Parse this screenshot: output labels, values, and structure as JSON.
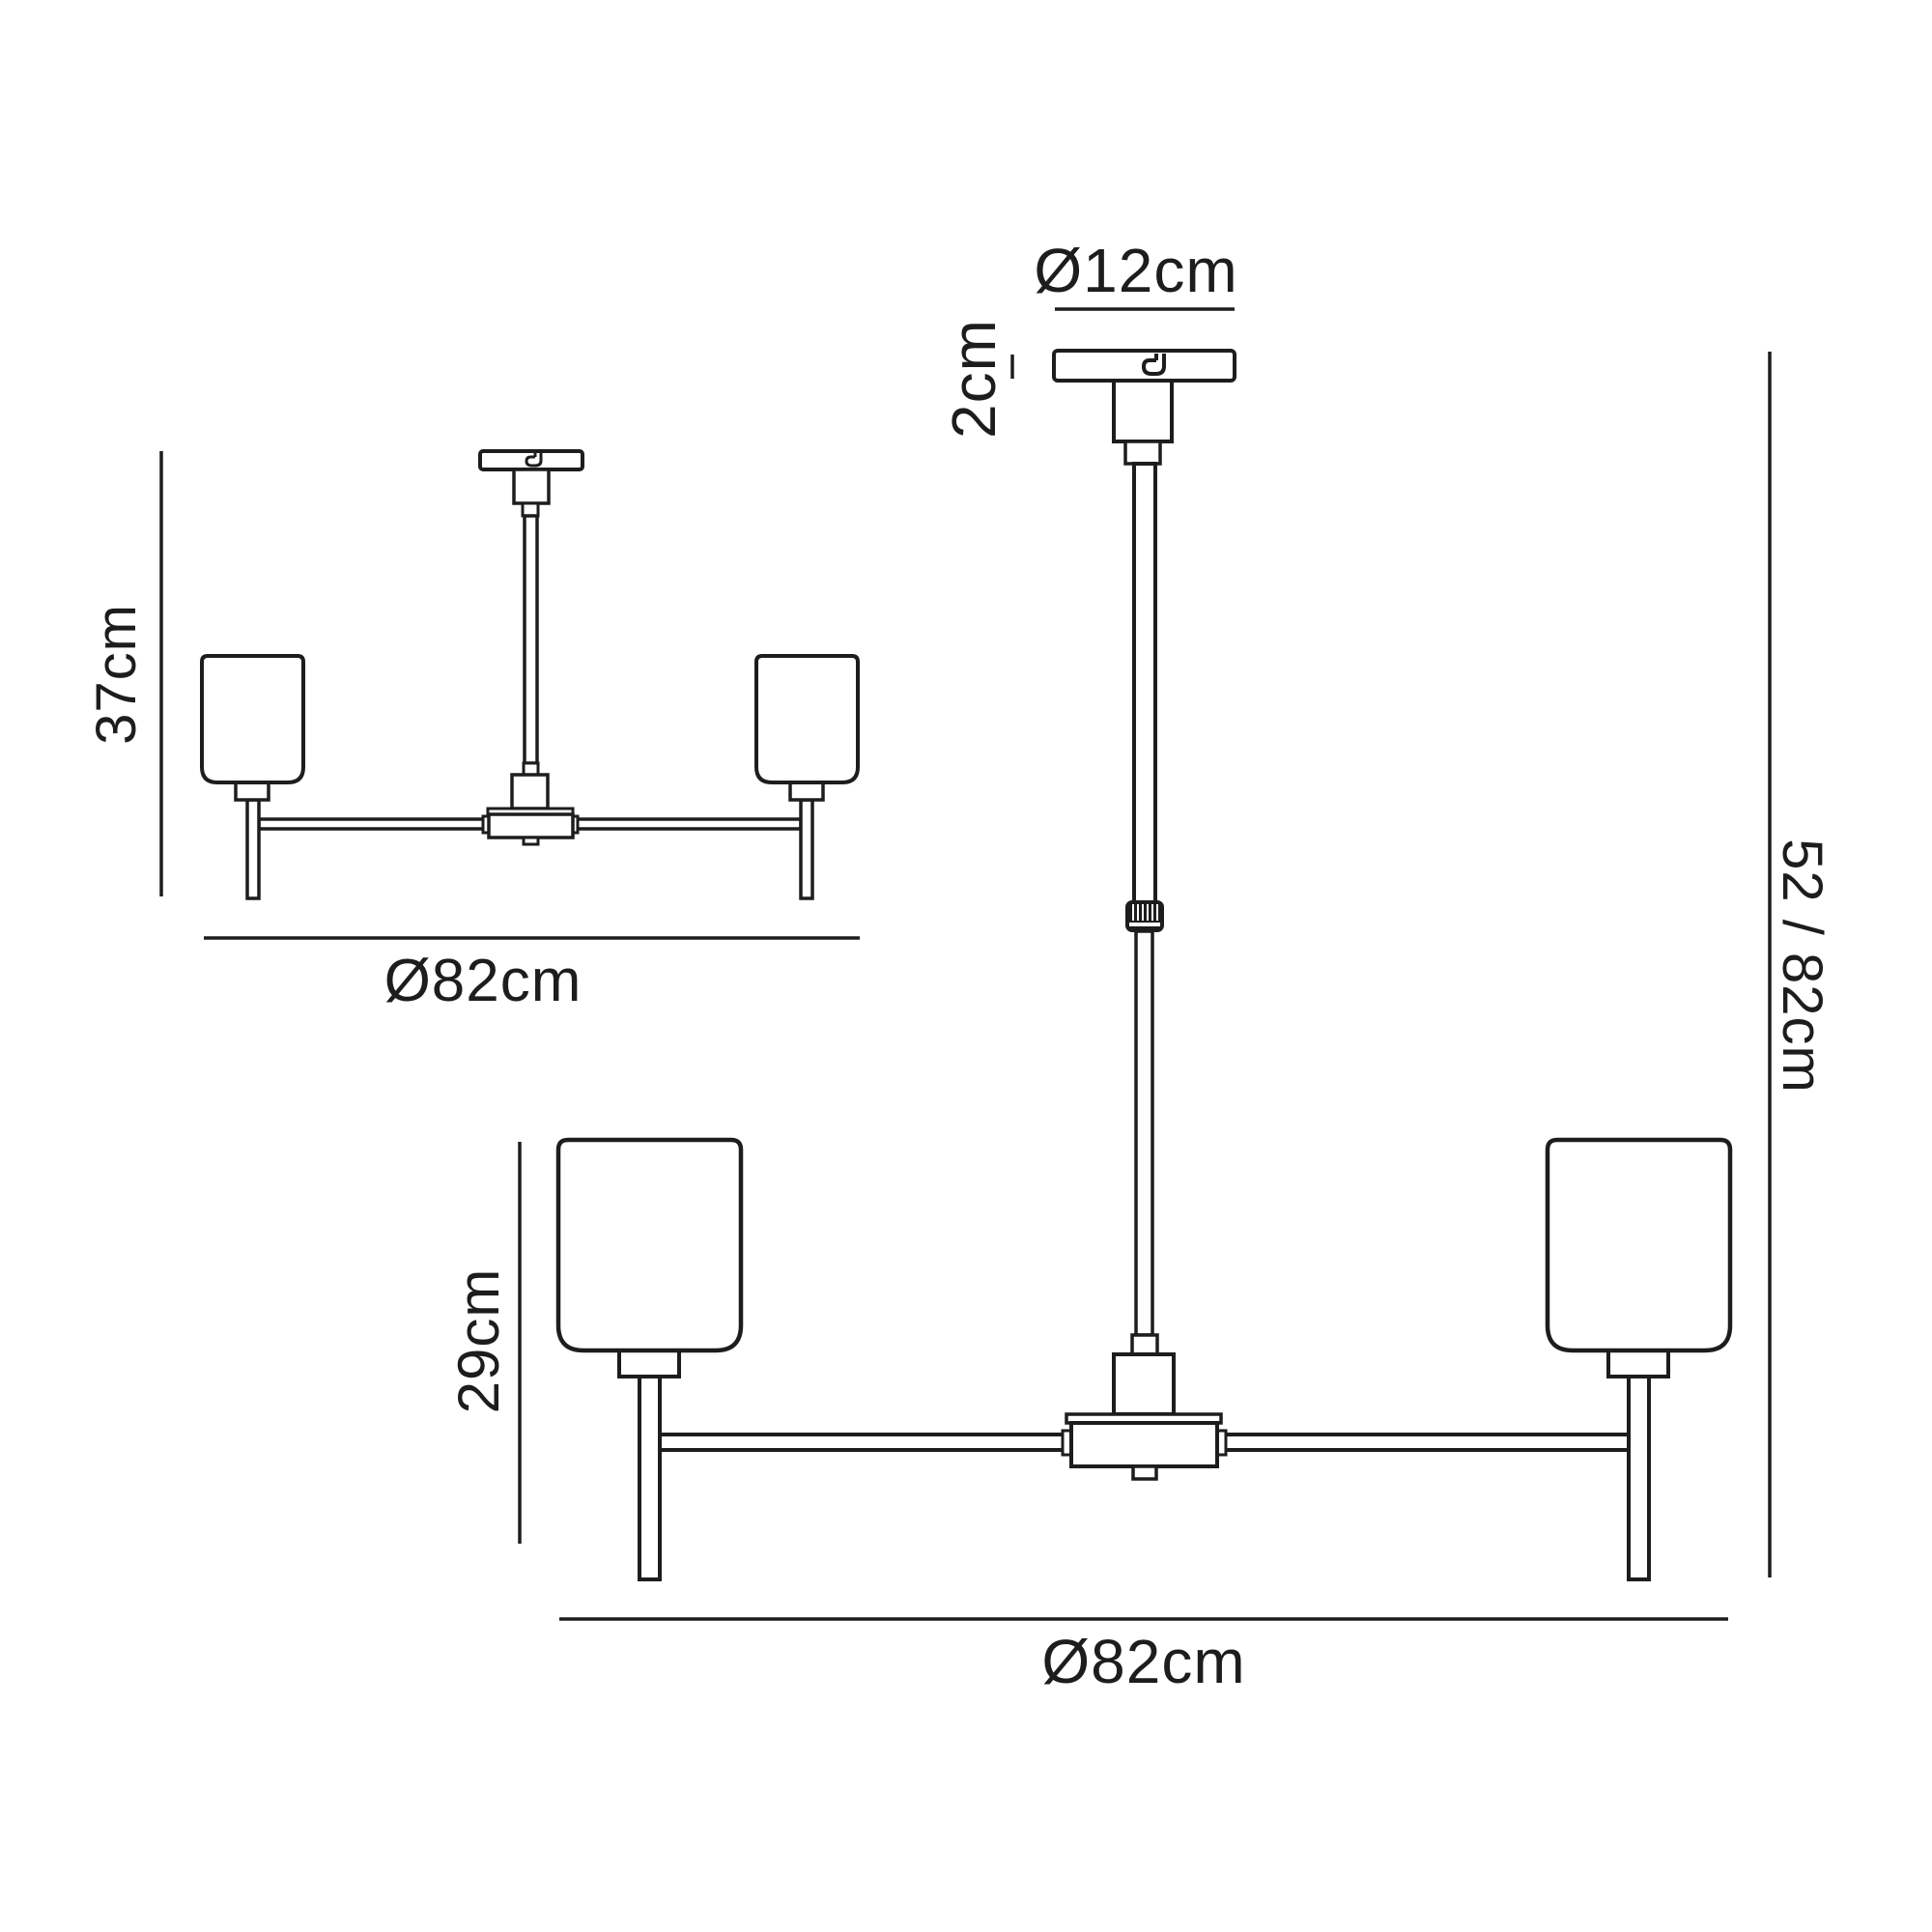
{
  "colors": {
    "background": "#ffffff",
    "line": "#1d1d1d"
  },
  "views": {
    "small": {
      "height_label": "37cm",
      "width_label": "Ø82cm"
    },
    "large": {
      "canopy_diameter_label": "Ø12cm",
      "canopy_height_label": "2cm",
      "drop_height_label": "52 / 82cm",
      "shade_height_label": "29cm",
      "width_label": "Ø82cm"
    }
  }
}
